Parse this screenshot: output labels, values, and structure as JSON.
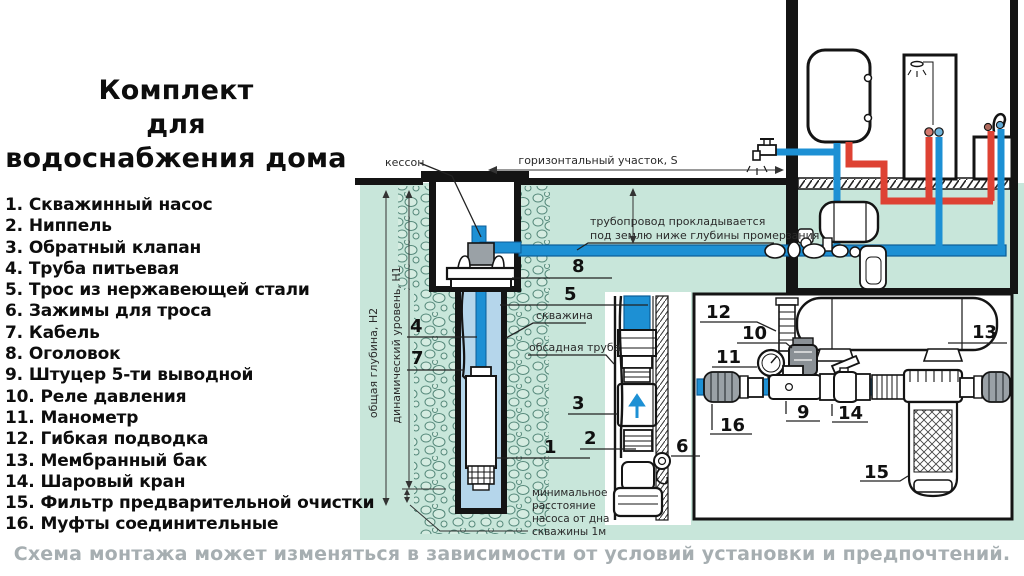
{
  "title": {
    "line1": "Комплект",
    "line2": "для",
    "line3": "водоснабжения дома"
  },
  "parts": {
    "items": [
      {
        "num": "1.",
        "name": "Скважинный насос"
      },
      {
        "num": "2.",
        "name": "Ниппель"
      },
      {
        "num": "3.",
        "name": "Обратный клапан"
      },
      {
        "num": "4.",
        "name": "Труба питьевая"
      },
      {
        "num": "5.",
        "name": "Трос из нержавеющей стали"
      },
      {
        "num": "6.",
        "name": "Зажимы для троса"
      },
      {
        "num": "7.",
        "name": "Кабель"
      },
      {
        "num": "8.",
        "name": "Оголовок"
      },
      {
        "num": "9.",
        "name": "Штуцер 5-ти выводной"
      },
      {
        "num": "10.",
        "name": "Реле давления"
      },
      {
        "num": "11.",
        "name": "Манометр"
      },
      {
        "num": "12.",
        "name": "Гибкая подводка"
      },
      {
        "num": "13.",
        "name": "Мембранный бак"
      },
      {
        "num": "14.",
        "name": "Шаровый кран"
      },
      {
        "num": "15.",
        "name": "Фильтр предварительной очистки"
      },
      {
        "num": "16.",
        "name": "Муфты соединительные"
      }
    ]
  },
  "diagram": {
    "labels": {
      "kesson": "кессон",
      "horizontal_span": "горизонтальный участок, S",
      "buried_line1": "трубопровод прокладывается",
      "buried_line2": "под землю ниже глубины промерзания",
      "total_depth": "общая глубина, H2",
      "dynamic_level": "динамический уровень, H1",
      "well": "скважина",
      "casing": "обсадная труба",
      "min_dist_line1": "минимальное",
      "min_dist_line2": "расстояние",
      "min_dist_line3": "насоса от дна",
      "min_dist_line4": "скважины 1м"
    },
    "callouts": {
      "c1": "1",
      "c2": "2",
      "c3": "3",
      "c4": "4",
      "c5": "5",
      "c6": "6",
      "c7": "7",
      "c8": "8",
      "c9": "9",
      "c10": "10",
      "c11": "11",
      "c12": "12",
      "c13": "13",
      "c14": "14",
      "c15": "15",
      "c16": "16"
    }
  },
  "footer": "Схема монтажа может изменяться в зависимости от условий установки и предпочтений.",
  "colors": {
    "ground": "#c8e6da",
    "pipe_blue": "#1d90d4",
    "pipe_red": "#de4233",
    "well_water": "#b5d6eb",
    "caption_gray": "#a6aeb1"
  }
}
